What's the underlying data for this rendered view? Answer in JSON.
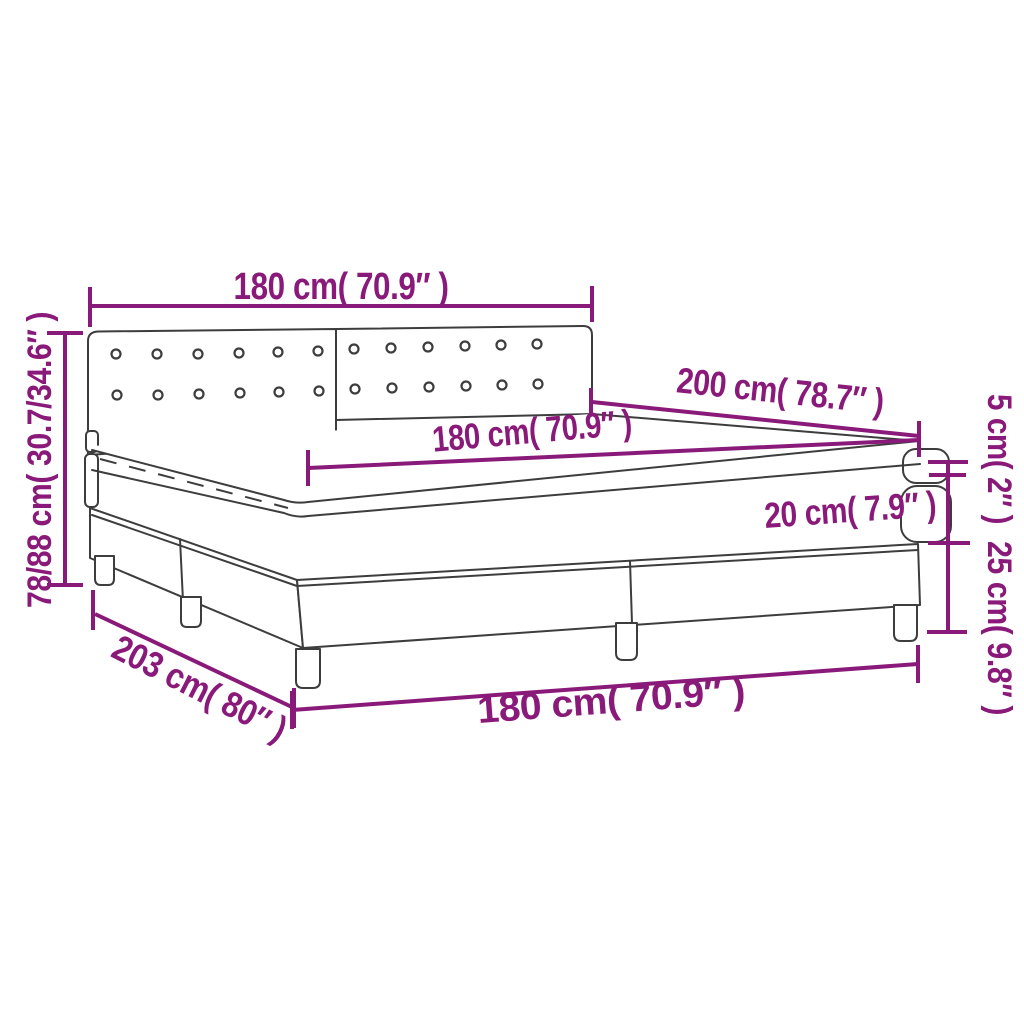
{
  "title": "Box spring bed dimension diagram",
  "colors": {
    "dimension_accent": "#8A1A7A",
    "drawing_outline": "#3D3D3D",
    "background": "#FFFFFF"
  },
  "labels": {
    "headboard_width": "180 cm( 70.9″ )",
    "bed_length": "200 cm( 78.7″ )",
    "mattress_width": "180 cm( 70.9″ )",
    "mattress_thickness": "20 cm( 7.9″ )",
    "topper_thickness": "5 cm( 2″ )",
    "base_height": "25 cm( 9.8″ )",
    "overall_height": "78/88 cm( 30.7/34.6″ )",
    "overall_length": "203 cm( 80″ )",
    "base_width": "180 cm( 70.9″ )"
  }
}
